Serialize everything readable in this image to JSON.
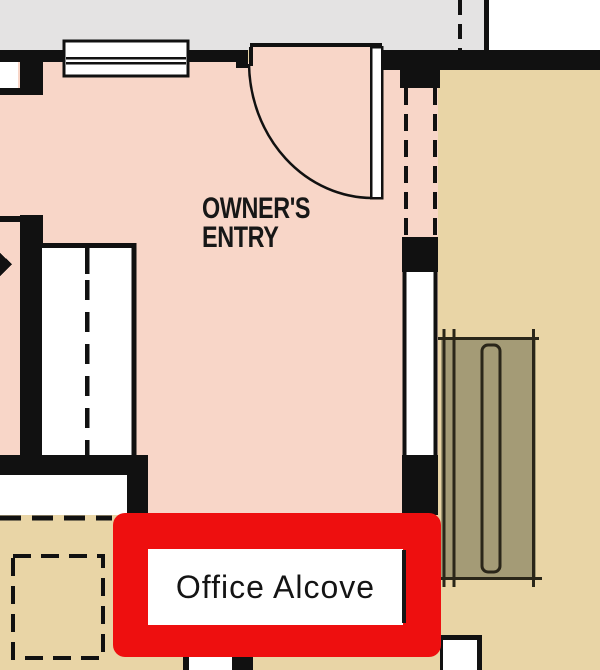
{
  "plan": {
    "room": {
      "line1": "OWNER'S",
      "line2": "ENTRY"
    },
    "annotation": {
      "label": "Office Alcove"
    },
    "colors": {
      "room_fill": "#f8d6c8",
      "floor_fill": "#e9d5a6",
      "exterior_fill": "#e4e3e3",
      "wall": "#111111",
      "desk_fill": "#a49b76",
      "highlight": "#ee0f0f",
      "label_bg": "#ffffff",
      "text": "#171717"
    }
  }
}
